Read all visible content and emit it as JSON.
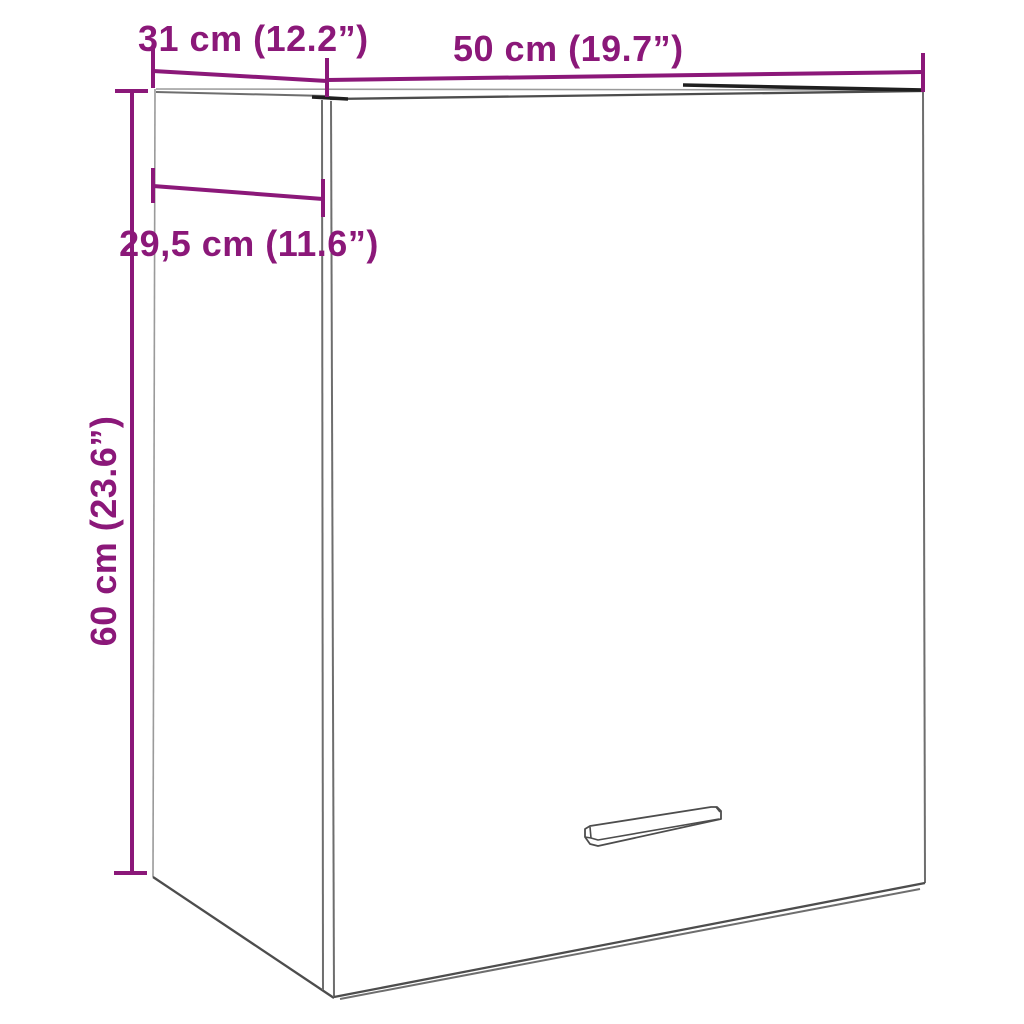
{
  "dimensions": {
    "depth_top": {
      "label": "31 cm (12.2”)"
    },
    "width_top": {
      "label": "50 cm (19.7”)"
    },
    "depth_inner": {
      "label": "29,5 cm (11.6”)"
    },
    "height_left": {
      "label": "60 cm (23.6”)"
    }
  },
  "colors": {
    "dimension_accent": "#8B1879",
    "cabinet_outline": "#4D4D4D",
    "cabinet_outline_dark": "#1F1F1F",
    "cabinet_outline_light": "#9A9A9A",
    "background": "#FFFFFF"
  }
}
